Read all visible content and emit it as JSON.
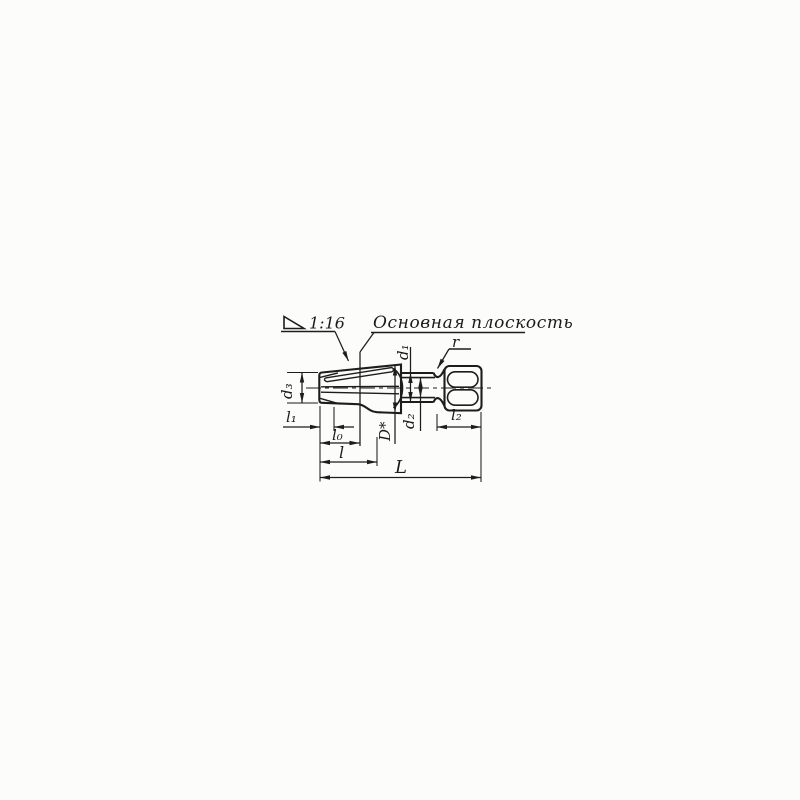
{
  "drawing": {
    "taper": {
      "value": "1:16"
    },
    "basic_plane_label": "Основная плоскость",
    "dims": {
      "d1": "d₁",
      "d2": "d₂",
      "d3": "d₃",
      "D_star": "D*",
      "l": "l",
      "l0": "l₀",
      "l1": "l₁",
      "l2": "l₂",
      "L": "L",
      "r": "r"
    }
  }
}
